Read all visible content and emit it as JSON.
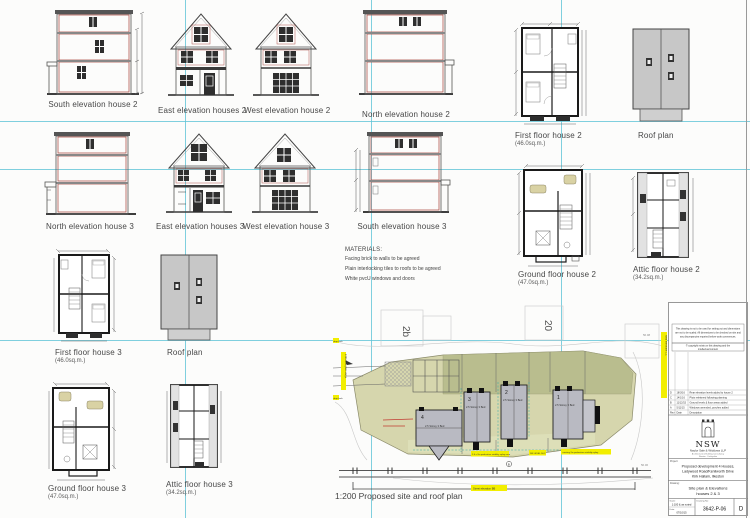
{
  "elevations": {
    "south2": "South elevation house 2",
    "east2": "East elevation houses 2",
    "west2": "West elevation house 2",
    "north2": "North elevation house 2",
    "north3": "North elevation house 3",
    "east3": "East elevation houses 3",
    "west3": "West elevation house 3",
    "south3": "South elevation house 3"
  },
  "plans": {
    "first2": {
      "label": "First floor house 2",
      "area": "(46.0sq.m.)"
    },
    "roof2": {
      "label": "Roof plan"
    },
    "ground2": {
      "label": "Ground floor house 2",
      "area": "(47.0sq.m.)"
    },
    "attic2": {
      "label": "Attic floor house 2",
      "area": "(34.2sq.m.)"
    },
    "first3": {
      "label": "First floor house 3",
      "area": "(46.0sq.m.)"
    },
    "roof3": {
      "label": "Roof plan"
    },
    "ground3": {
      "label": "Ground floor house 3",
      "area": "(47.0sq.m.)"
    },
    "attic3": {
      "label": "Attic floor house 3",
      "area": "(34.2sq.m.)"
    }
  },
  "materials": {
    "title": "MATERIALS:",
    "line1": "Facing brick to walls to be agreed",
    "line2": "Plain interlocking tiles to roofs to be agreed",
    "line3": "White pvcU windows and doors"
  },
  "site": {
    "caption": "1:200 Proposed site and roof plan",
    "neighbour_2b": "2b",
    "neighbour_20": "20",
    "houses": [
      {
        "no": "4",
        "type": "2.5 Storey 3 Bed"
      },
      {
        "no": "3",
        "type": "2.5 Storey 3 Bed"
      },
      {
        "no": "2",
        "type": "2.5 Storey 3 Bed"
      },
      {
        "no": "1",
        "type": "2.5 Storey 3 Bed"
      }
    ],
    "levels": {
      "tr": "56.08",
      "br": "56.06"
    },
    "marker_b": "B",
    "ann": {
      "flag1": "drop kerb",
      "flag2": "drop kerb",
      "verge": "2.0m wide grass verge",
      "right": "road elevation CC",
      "splay1": "2.4 x 2m pedestrian visibility splay area",
      "level": "DN LEVEL 56.2",
      "splay2": "existing 2m pedestrian visibility splay",
      "street": "Street elevation BB"
    }
  },
  "title_block": {
    "disclaimer1": "This drawing is not to be used for setting out and dimensions",
    "disclaimer2": "are not to be scaled. All dimensions to be checked on site and",
    "disclaimer3": "any discrepancies reported before work commences.",
    "copyright1": "© copyright exists on this drawing and the",
    "copyright2": "intellectual content",
    "rev_header": {
      "rev": "Rev",
      "date": "Date",
      "desc": "Description"
    },
    "revisions": [
      {
        "rev": "D",
        "date": "18/3/16",
        "desc": "Rear elevation levels added to house 2"
      },
      {
        "rev": "C",
        "date": "14/1/16",
        "desc": "Plots relettered following planning"
      },
      {
        "rev": "B",
        "date": "11/12/15",
        "desc": "Ground levels & floor areas added"
      },
      {
        "rev": "A",
        "date": "5/11/15",
        "desc": "Windows amended, porches added"
      }
    ],
    "logo_initials": "NSW",
    "firm_name": "Naylor Sale & Widdows LLP",
    "firm_sub1": "Architectural & Building Consultancy",
    "firm_sub2": "Ilkeston · Derbyshire",
    "project_label": "Project:",
    "project1": "Proposed development 4 Houses,",
    "project2": "Ladywood Road/Kenilworth Drive",
    "project3": "Kirk Hallam, Ilkeston",
    "drawing_label": "Drawing:",
    "drawing1": "Site plan & Elevations",
    "drawing2": "houses 2 & 3",
    "scale_label": "Scale:",
    "scale": "1:100 & as noted",
    "date_label": "Date:",
    "date": "07/10/15",
    "number_label": "Drawing No:",
    "number": "3642-P-06",
    "revision": "D"
  },
  "colors": {
    "registration_cyan": "#5fc3d7",
    "elevation_red": "#b0564e",
    "highlight_yellow": "#f2ee00",
    "site_khaki": "#d6d6ad",
    "roof_grey": "#c7c7c7"
  }
}
